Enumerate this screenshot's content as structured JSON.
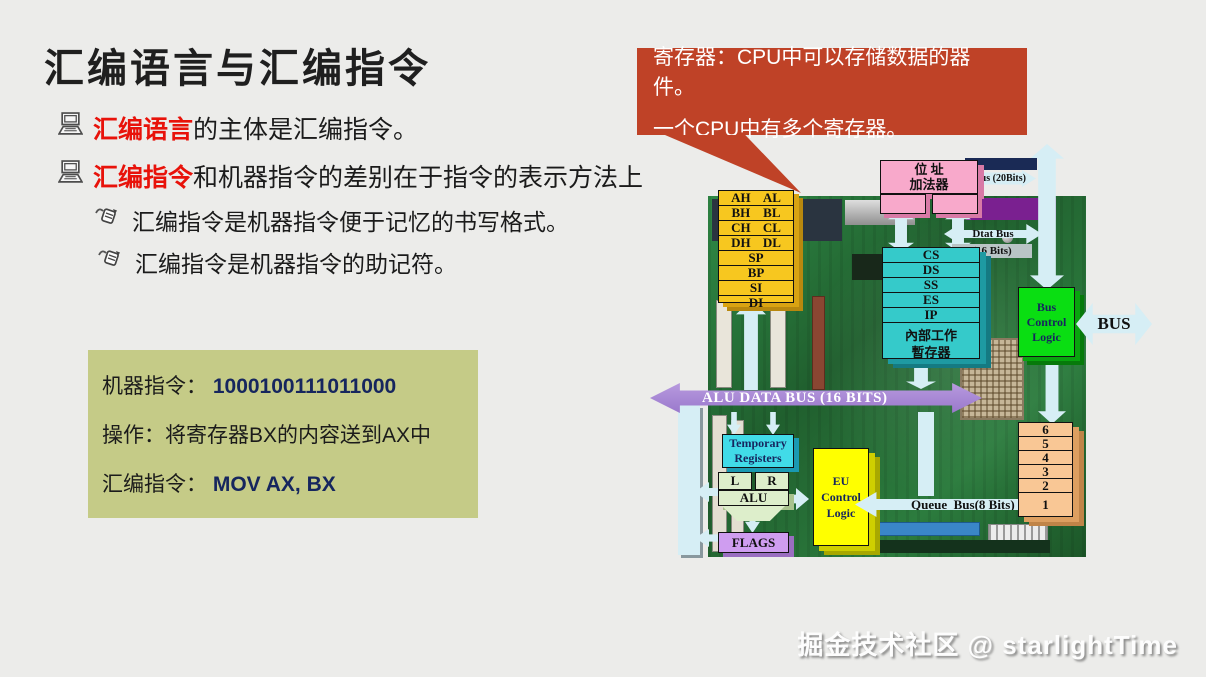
{
  "slide": {
    "title": "汇编语言与汇编指令",
    "bullets": [
      {
        "highlight": "汇编语言",
        "rest": "的主体是汇编指令。"
      },
      {
        "highlight": "汇编指令",
        "rest": "和机器指令的差别在于指令的表示方法上"
      }
    ],
    "sub_bullets": [
      "汇编指令是机器指令便于记忆的书写格式。",
      "汇编指令是机器指令的助记符。"
    ],
    "example_box": {
      "machine_label": "机器指令：",
      "machine_value": "1000100111011000",
      "operation": "操作：将寄存器BX的内容送到AX中",
      "assembly_label": "汇编指令：",
      "assembly_value": "MOV AX, BX"
    },
    "callout": {
      "line1": "寄存器：CPU中可以存储数据的器件。",
      "line2": "一个CPU中有多个寄存器。"
    },
    "watermark": "掘金技术社区 @ starlightTime"
  },
  "diagram": {
    "general_registers": [
      [
        "AH",
        "AL"
      ],
      [
        "BH",
        "BL"
      ],
      [
        "CH",
        "CL"
      ],
      [
        "DH",
        "DL"
      ],
      [
        "SP"
      ],
      [
        "BP"
      ],
      [
        "SI"
      ],
      [
        "DI"
      ]
    ],
    "address_adder": {
      "line1": "位 址",
      "line2": "加法器"
    },
    "bus20_label": "Bus (20Bits)",
    "data_bus": {
      "line1": "Dtat Bus",
      "line2": "(16 Bits)"
    },
    "segment_registers": [
      "CS",
      "DS",
      "SS",
      "ES",
      "IP"
    ],
    "internal_regs": {
      "line1": "內部工作",
      "line2": "暫存器"
    },
    "bus_control_logic": {
      "line1": "Bus",
      "line2": "Control",
      "line3": "Logic"
    },
    "bus_label": "BUS",
    "alu_bus_label": "ALU DATA BUS (16 BITS)",
    "temp_registers": {
      "line1": "Temporary",
      "line2": "Registers"
    },
    "alu_left": "L",
    "alu_right": "R",
    "alu_label": "ALU",
    "flags_label": "FLAGS",
    "eu_control_logic": {
      "line1": "EU",
      "line2": "Control",
      "line3": "Logic"
    },
    "queue_bus_label": "Queue  Bus(8 Bits)",
    "queue_cells": [
      "6",
      "5",
      "4",
      "3",
      "2",
      "1"
    ],
    "colors": {
      "slide_bg": "#ececea",
      "accent_red": "#e8120a",
      "callout_bg": "#bf4227",
      "example_bg": "#c5cb87",
      "value_navy": "#16265e",
      "register_yellow": "#f7c71f",
      "adder_pink": "#f8a9cb",
      "segment_cyan": "#35caca",
      "control_green": "#0ade12",
      "eu_yellow": "#ffff00",
      "queue_orange": "#f9c795",
      "alu_bus_purple": "#a182d2",
      "flags_purple": "#cf9df0",
      "temp_cyan": "#41dbe8",
      "alu_green": "#ddeecb",
      "arrow_cyan": "#d6eef5",
      "pcb_green": "#2c7c3e"
    }
  }
}
